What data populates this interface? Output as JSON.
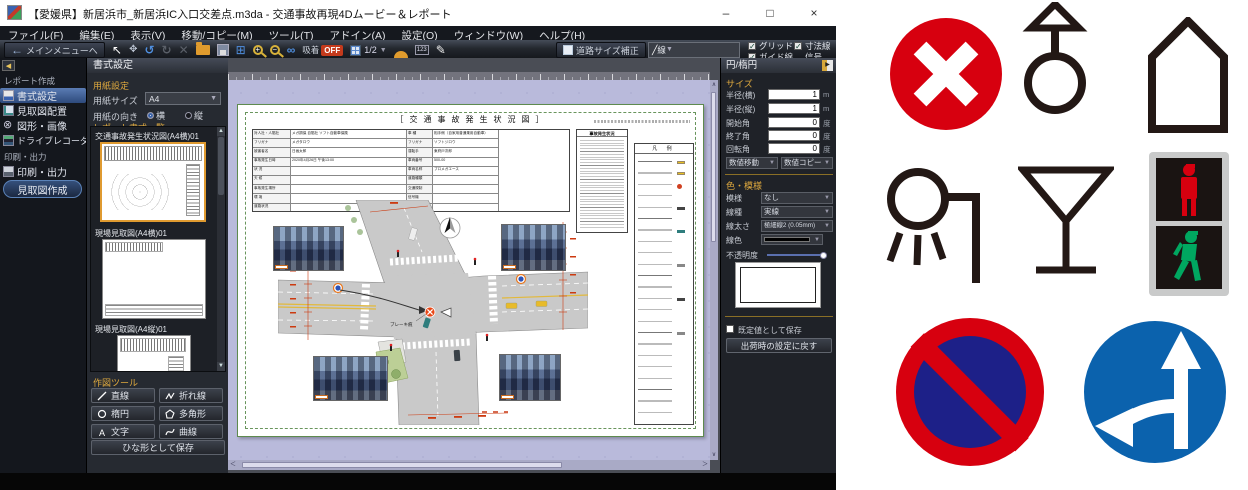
{
  "window": {
    "title": "【愛媛県】新居浜市_新居浜IC入口交差点.m3da - 交通事故再現4Dムービー＆レポート",
    "minimize": "–",
    "maximize": "□",
    "close": "×"
  },
  "menubar": {
    "items": [
      "ファイル(F)",
      "編集(E)",
      "表示(V)",
      "移動/コピー(M)",
      "ツール(T)",
      "アドイン(A)",
      "設定(O)",
      "ウィンドウ(W)",
      "ヘルプ(H)"
    ]
  },
  "toolbar": {
    "back_button": "メインメニューへ",
    "snap_label": "吸着",
    "snap_state": "OFF",
    "grid_scale": "1/2",
    "road_size_button": "道路サイズ補正",
    "line_dropdown": "線",
    "checks": [
      {
        "label": "グリッド",
        "checked": "✓"
      },
      {
        "label": "ガイド線",
        "checked": "✓"
      },
      {
        "label": "寸法線",
        "checked": "✓"
      },
      {
        "label": "信号(3D)",
        "checked": "✓"
      }
    ]
  },
  "guide_button": "使い方ガイド",
  "sidebar": {
    "section_report": "レポート作成",
    "items": [
      "書式設定",
      "見取図配置",
      "図形・画像",
      "ドライブレコーダ"
    ],
    "section_print": "印刷・出力",
    "print_item": "印刷・出力",
    "create_button": "見取図作成"
  },
  "format_panel": {
    "header": "書式設定",
    "paper_section": "用紙設定",
    "paper_size_label": "用紙サイズ",
    "paper_size_value": "A4",
    "orientation_label": "用紙の向き",
    "orientation_h": "横",
    "orientation_v": "縦",
    "list_section": "レポート書式一覧",
    "templates": [
      "交通事故発生状況図(A4横)01",
      "現場見取図(A4横)01",
      "現場見取図(A4縦)01"
    ],
    "tools_section": "作図ツール",
    "tool_buttons": [
      "直線",
      "折れ線",
      "楕円",
      "多角形",
      "文字",
      "曲線"
    ],
    "save_template_button": "ひな形として保存"
  },
  "document": {
    "title": "［ 交 通 事 故 発 生 状 況 図 ］",
    "legend_title": "凡 例",
    "situation_header": "事故発生状況",
    "brake_label": "ブレーキ痕",
    "table": {
      "left_labels": [
        "対人社・人賠社",
        "フリガナ",
        "被害者名",
        "事故発生日時",
        "状  況",
        "天  候",
        "事故発生場所",
        "環  境",
        "道路状況"
      ],
      "col_v1": [
        "メガ損保  自賠社 ソフト自動車保険",
        "メガタロウ",
        "日画太郎",
        "2020年4月26日  午後13:00",
        "",
        "",
        "",
        "",
        ""
      ],
      "mid_labels": [
        "車  種",
        "フリガナ",
        "運転手",
        "車両番号",
        "車両名称",
        "道路種類",
        "交通規制",
        "信号機",
        "道路勾配"
      ],
      "col_v2": [
        "相手側（自家用普通乗用自動車）",
        "ソフトジロウ",
        "東府戸次郎",
        "500-00",
        "プロメガエース",
        "",
        "",
        "",
        ""
      ],
      "col_v3": [
        "自賠責契約車（自家用普通乗用自動車）",
        "メガタロウ",
        "日画太郎",
        "600-00",
        "ソフトハイブリッド",
        "",
        "",
        "",
        ""
      ]
    }
  },
  "properties_panel": {
    "header": "円/楕円",
    "popout": "▶",
    "size_section": "サイズ",
    "fields": [
      {
        "label": "半径(横)",
        "value": "1",
        "unit": "m"
      },
      {
        "label": "半径(縦)",
        "value": "1",
        "unit": "m"
      },
      {
        "label": "開始角",
        "value": "0",
        "unit": "度"
      },
      {
        "label": "終了角",
        "value": "0",
        "unit": "度"
      },
      {
        "label": "回転角",
        "value": "0",
        "unit": "度"
      }
    ],
    "move_dropdown": "数値移動",
    "copy_dropdown": "数値コピー",
    "color_section": "色・模様",
    "pattern_label": "模様",
    "pattern_value": "なし",
    "linetype_label": "線種",
    "linetype_value": "実線",
    "linewidth_label": "線太さ",
    "linewidth_value": "極細線2 (0.05mm)",
    "linecolor_label": "線色",
    "opacity_label": "不透明度",
    "default_checkbox": "既定値として保存",
    "reset_button": "出荷時の設定に戻す"
  },
  "symbols": {
    "names": [
      "collision-x-symbol",
      "signal-map-symbol",
      "building-symbol",
      "streetlight-symbol",
      "signal-post-symbol",
      "pedestrian-signal-symbol",
      "no-parking-sign",
      "designated-direction-sign"
    ],
    "colors": {
      "traffic_red": "#d7000f",
      "sign_blue": "#0b62ad",
      "no_parking_inner": "#1d2088",
      "outline_black": "#231815",
      "walk_green": "#00a760",
      "housing_gray": "#c9caca"
    }
  }
}
